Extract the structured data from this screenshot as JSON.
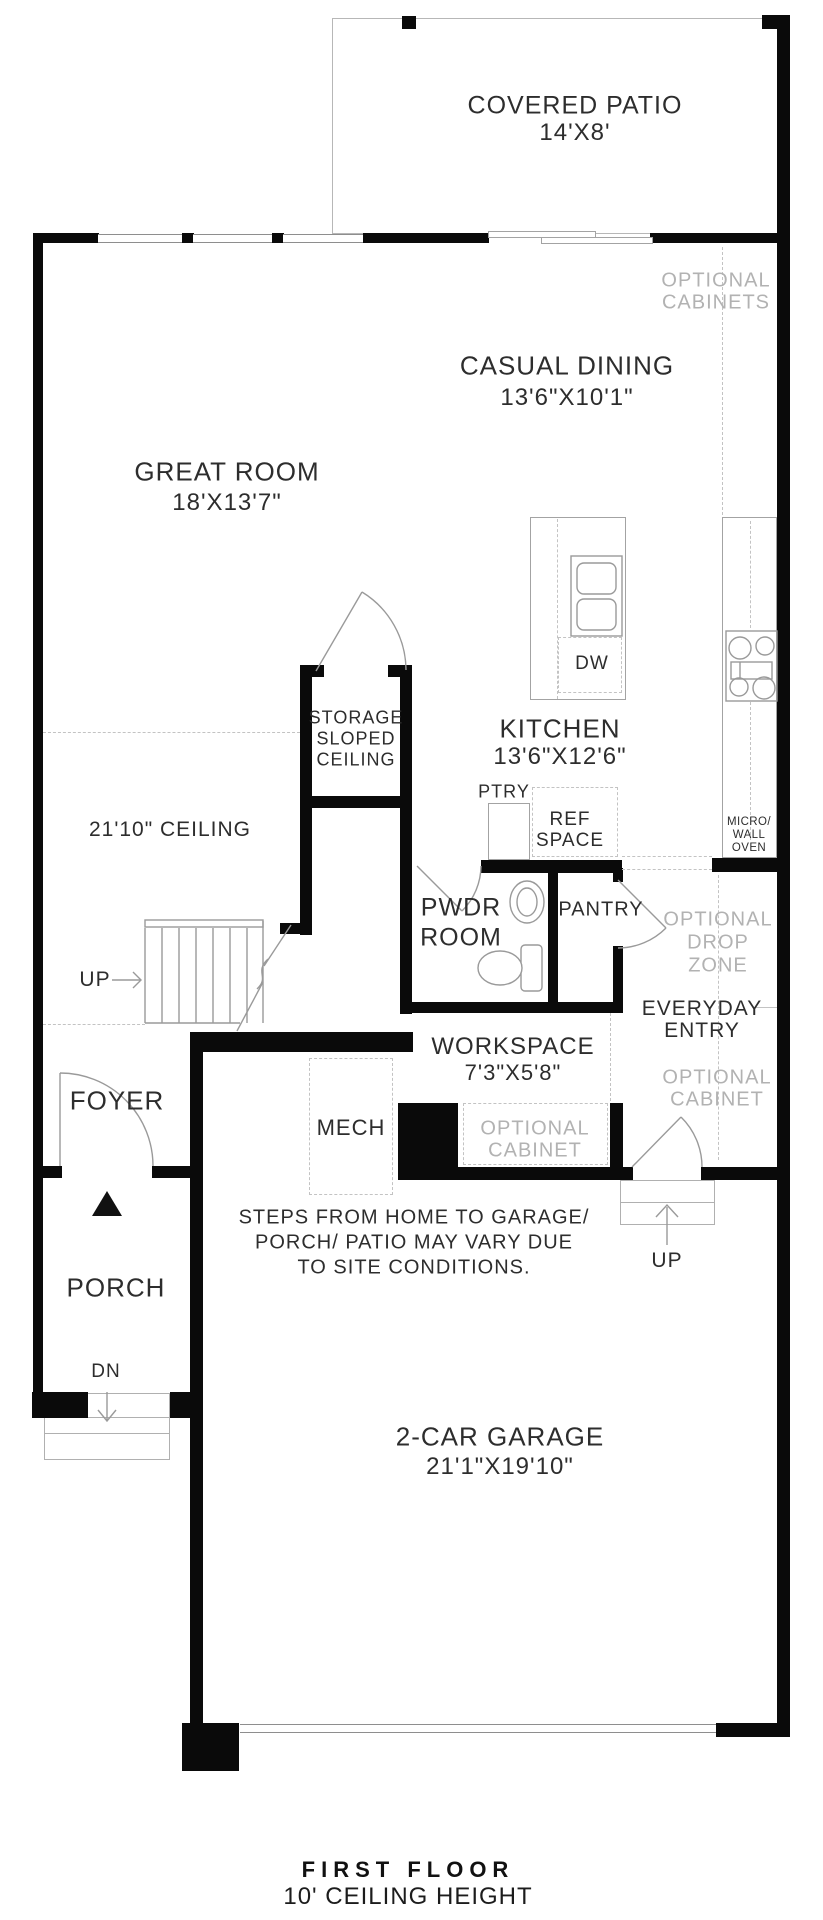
{
  "plan_title": {
    "line1": "FIRST FLOOR",
    "line2": "10' CEILING HEIGHT"
  },
  "rooms": {
    "covered_patio": {
      "name": "COVERED PATIO",
      "dims": "14'X8'"
    },
    "casual_dining": {
      "name": "CASUAL DINING",
      "dims": "13'6\"X10'1\""
    },
    "great_room": {
      "name": "GREAT ROOM",
      "dims": "18'X13'7\""
    },
    "kitchen": {
      "name": "KITCHEN",
      "dims": "13'6\"X12'6\""
    },
    "storage": {
      "line1": "STORAGE",
      "line2": "SLOPED",
      "line3": "CEILING"
    },
    "pwdr_room": {
      "line1": "PWDR",
      "line2": "ROOM"
    },
    "pantry": {
      "name": "PANTRY"
    },
    "workspace": {
      "name": "WORKSPACE",
      "dims": "7'3\"X5'8\""
    },
    "everyday_entry": {
      "line1": "EVERYDAY",
      "line2": "ENTRY"
    },
    "mech": {
      "name": "MECH"
    },
    "foyer": {
      "name": "FOYER"
    },
    "porch": {
      "name": "PORCH"
    },
    "garage": {
      "name": "2-CAR GARAGE",
      "dims": "21'1\"X19'10\""
    }
  },
  "annotations": {
    "optional_cabinets": {
      "line1": "OPTIONAL",
      "line2": "CABINETS"
    },
    "optional_drop_zone": {
      "line1": "OPTIONAL",
      "line2": "DROP",
      "line3": "ZONE"
    },
    "optional_cabinet_entry": {
      "line1": "OPTIONAL",
      "line2": "CABINET"
    },
    "optional_cabinet_workspace": {
      "line1": "OPTIONAL",
      "line2": "CABINET"
    },
    "ceiling_note": "21'10\" CEILING",
    "pantry_cabinet": "PTRY",
    "ref_space": {
      "line1": "REF",
      "line2": "SPACE"
    },
    "micro_wall_oven": {
      "line1": "MICRO/",
      "line2": "WALL",
      "line3": "OVEN"
    },
    "dishwasher": "DW",
    "stairs_up": "UP",
    "entry_up": "UP",
    "porch_dn": "DN",
    "site_note": {
      "line1": "STEPS FROM HOME TO GARAGE/",
      "line2": "PORCH/ PATIO MAY VARY DUE",
      "line3": "TO SITE CONDITIONS."
    }
  },
  "colors": {
    "wall": "#0a0a0a",
    "label": "#2d2d2d",
    "muted_label": "#b2b2b2",
    "fixture_line": "#9a9a9a",
    "dashed_line": "#c3c3c3"
  }
}
